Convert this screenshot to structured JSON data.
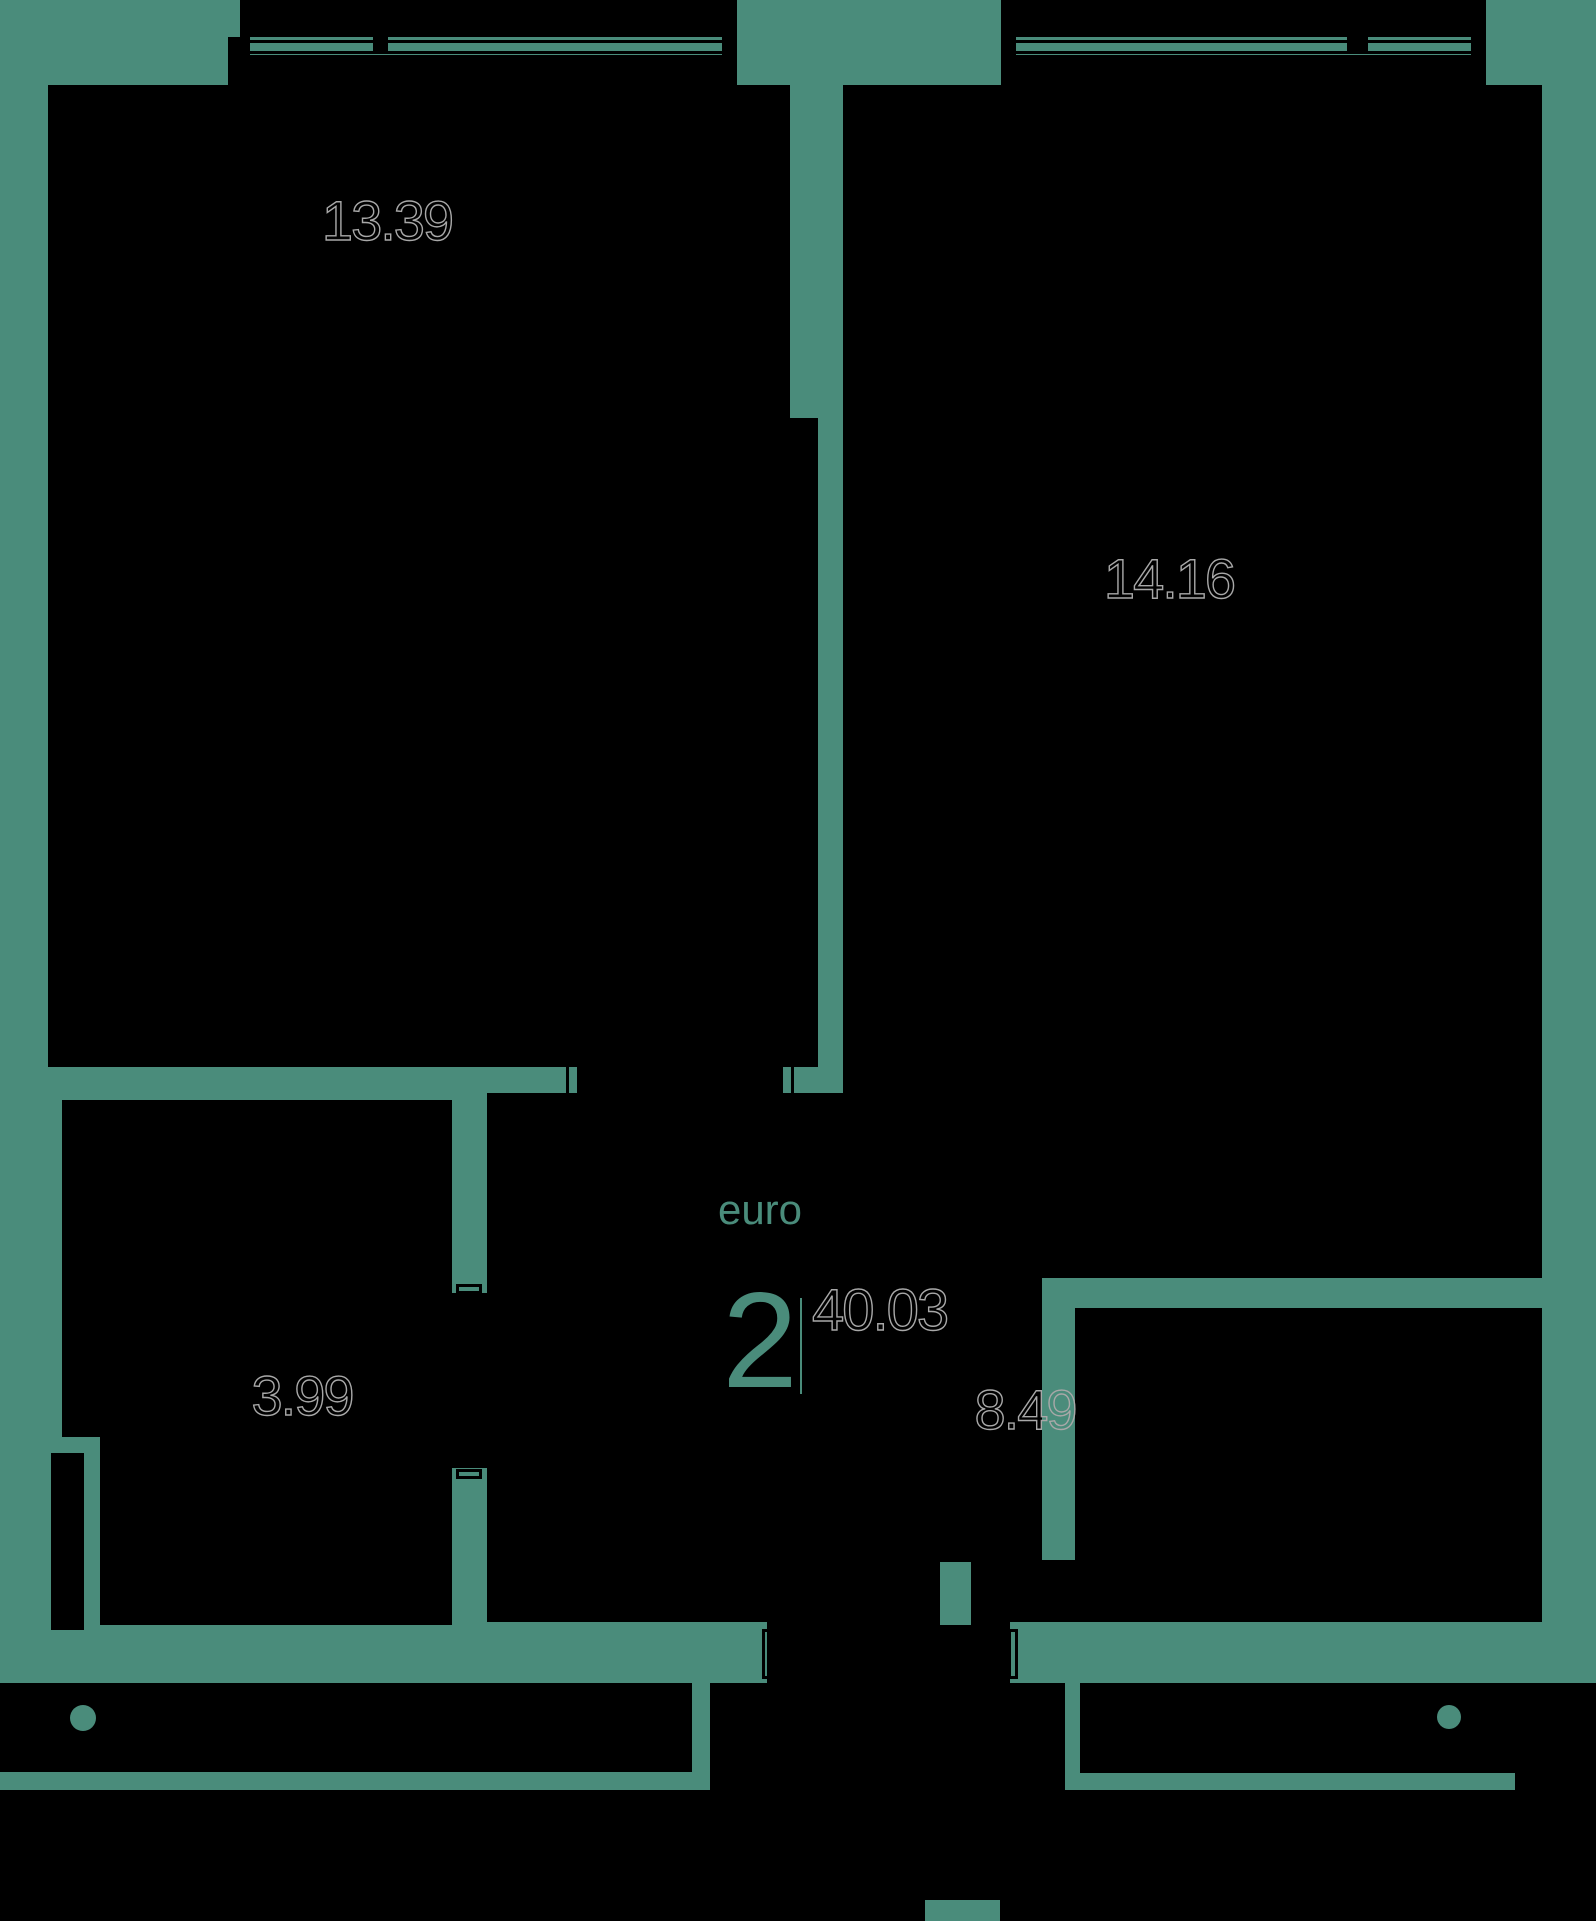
{
  "plan": {
    "type_label": "euro",
    "rooms_count": "2",
    "total_area": "40.03",
    "rooms": [
      {
        "name": "room-top-left",
        "area": "13.39"
      },
      {
        "name": "room-top-right",
        "area": "14.16"
      },
      {
        "name": "room-bottom-left",
        "area": "3.99"
      },
      {
        "name": "hallway",
        "area": "8.49"
      }
    ],
    "colors": {
      "background": "#4a8c7b",
      "room_fill": "#000000",
      "area_label_stroke": "#a8a8a8",
      "accent_text": "#4a8c7b"
    }
  }
}
